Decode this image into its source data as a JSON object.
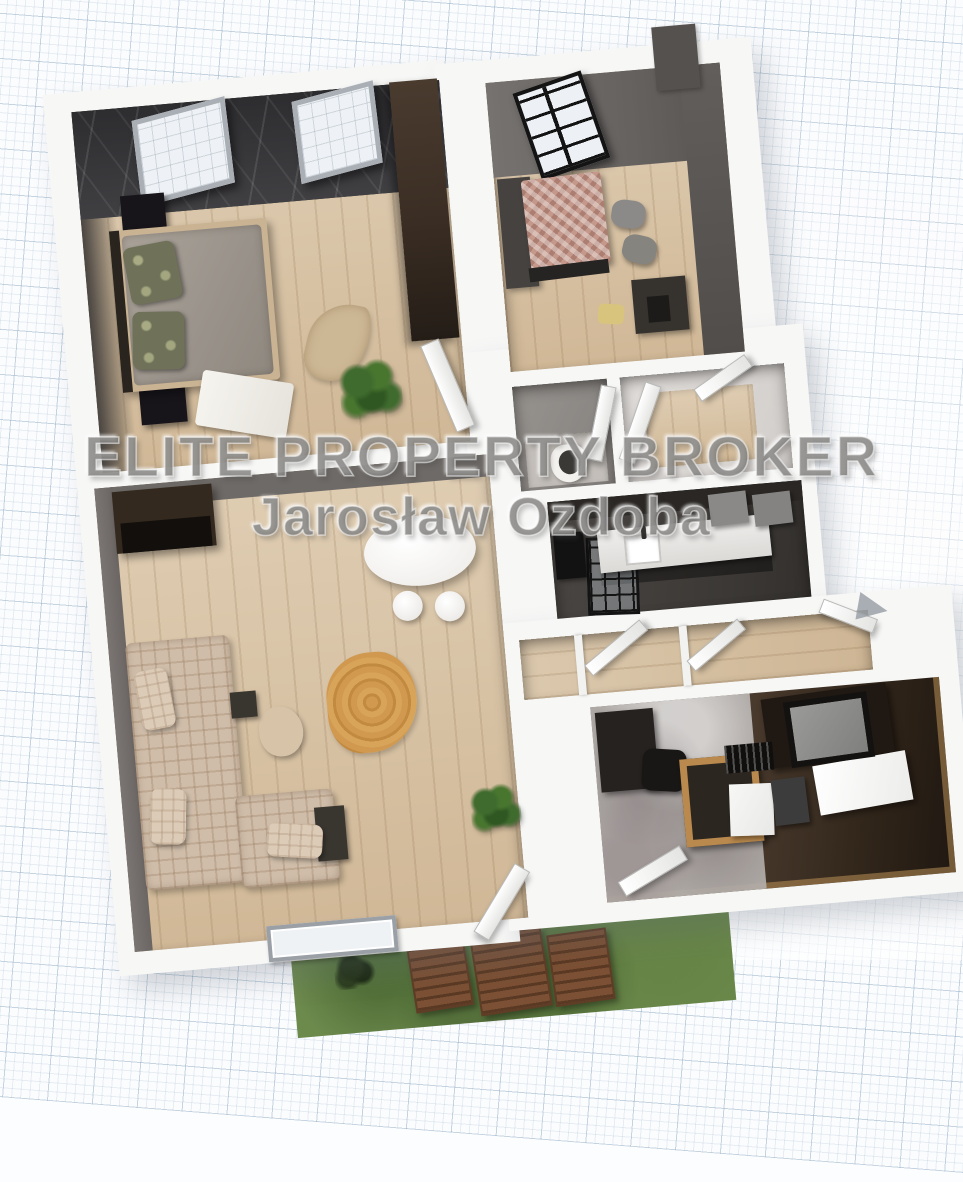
{
  "watermark": {
    "line1": "ELITE PROPERTY BROKER",
    "line2": "Jarosław Ozdoba"
  },
  "scene": {
    "type": "3d-floor-plan-render",
    "background": "graph-paper-grid",
    "rooms": [
      {
        "name": "bedroom-main",
        "features": [
          "dark-marble-accent-wall",
          "two-skylight-windows",
          "double-bed-grey-duvet",
          "olive-patterned-pillows",
          "black-nightstands",
          "tall-brown-wardrobe",
          "leaf-shaped-rug",
          "monstera-plant",
          "white-throw-blanket",
          "open-door"
        ]
      },
      {
        "name": "bedroom-second",
        "features": [
          "black-grid-window",
          "checkered-bedspread",
          "grey-wardrobe",
          "two-grey-floor-pouffes",
          "dark-desk",
          "beige-chair"
        ]
      },
      {
        "name": "wc",
        "features": [
          "toilet",
          "open-door",
          "grey-walls"
        ]
      },
      {
        "name": "bathroom",
        "features": [
          "open-white-doors",
          "wood-floor",
          "light-walls"
        ]
      },
      {
        "name": "kitchen",
        "features": [
          "white-countertop-with-sink",
          "faucet",
          "grey-wall-cabinets",
          "black-glass-partition",
          "dark-fridge",
          "dark-walls"
        ]
      },
      {
        "name": "hallway",
        "features": [
          "open-white-doors",
          "wood-floor",
          "open-tilted-window"
        ]
      },
      {
        "name": "living-room",
        "features": [
          "l-shaped-plaid-sofa",
          "white-oval-table",
          "two-white-stools",
          "round-orange-rug",
          "beige-pouffe",
          "dark-sideboard",
          "coffee-tables",
          "plant",
          "window-in-bottom-wall",
          "open-garden-door"
        ]
      },
      {
        "name": "study",
        "features": [
          "concrete-accent-wall",
          "tv-grey-screen",
          "wooden-desk",
          "black-office-chair",
          "white-cabinets",
          "dark-brown-walls",
          "open-door"
        ]
      }
    ],
    "exterior": {
      "name": "garden",
      "features": [
        "grass-lawn",
        "wooden-garden-table",
        "two-wooden-garden-chairs",
        "dark-shrub"
      ]
    },
    "annotations": [
      {
        "name": "direction-arrow",
        "shape": "grey-triangle-right"
      }
    ],
    "colors": {
      "paper": "#fbfcfe",
      "grid_line": "#c2cedd",
      "wall_white": "#f7f7f6",
      "floor_oak": "#d8c2a2",
      "accent_marble_dark": "#343437",
      "wall_grey": "#6b6764",
      "wardrobe_brown": "#41332a",
      "sofa_plaid_beige": "#cfbda9",
      "rug_orange": "#d0994f",
      "bedspread_check": "#c4988a",
      "pillow_olive": "#6f7158",
      "grass_green": "#6d8a4d",
      "garden_wood_brown": "#7b5034",
      "tv_grey": "#8d8d8b"
    }
  }
}
